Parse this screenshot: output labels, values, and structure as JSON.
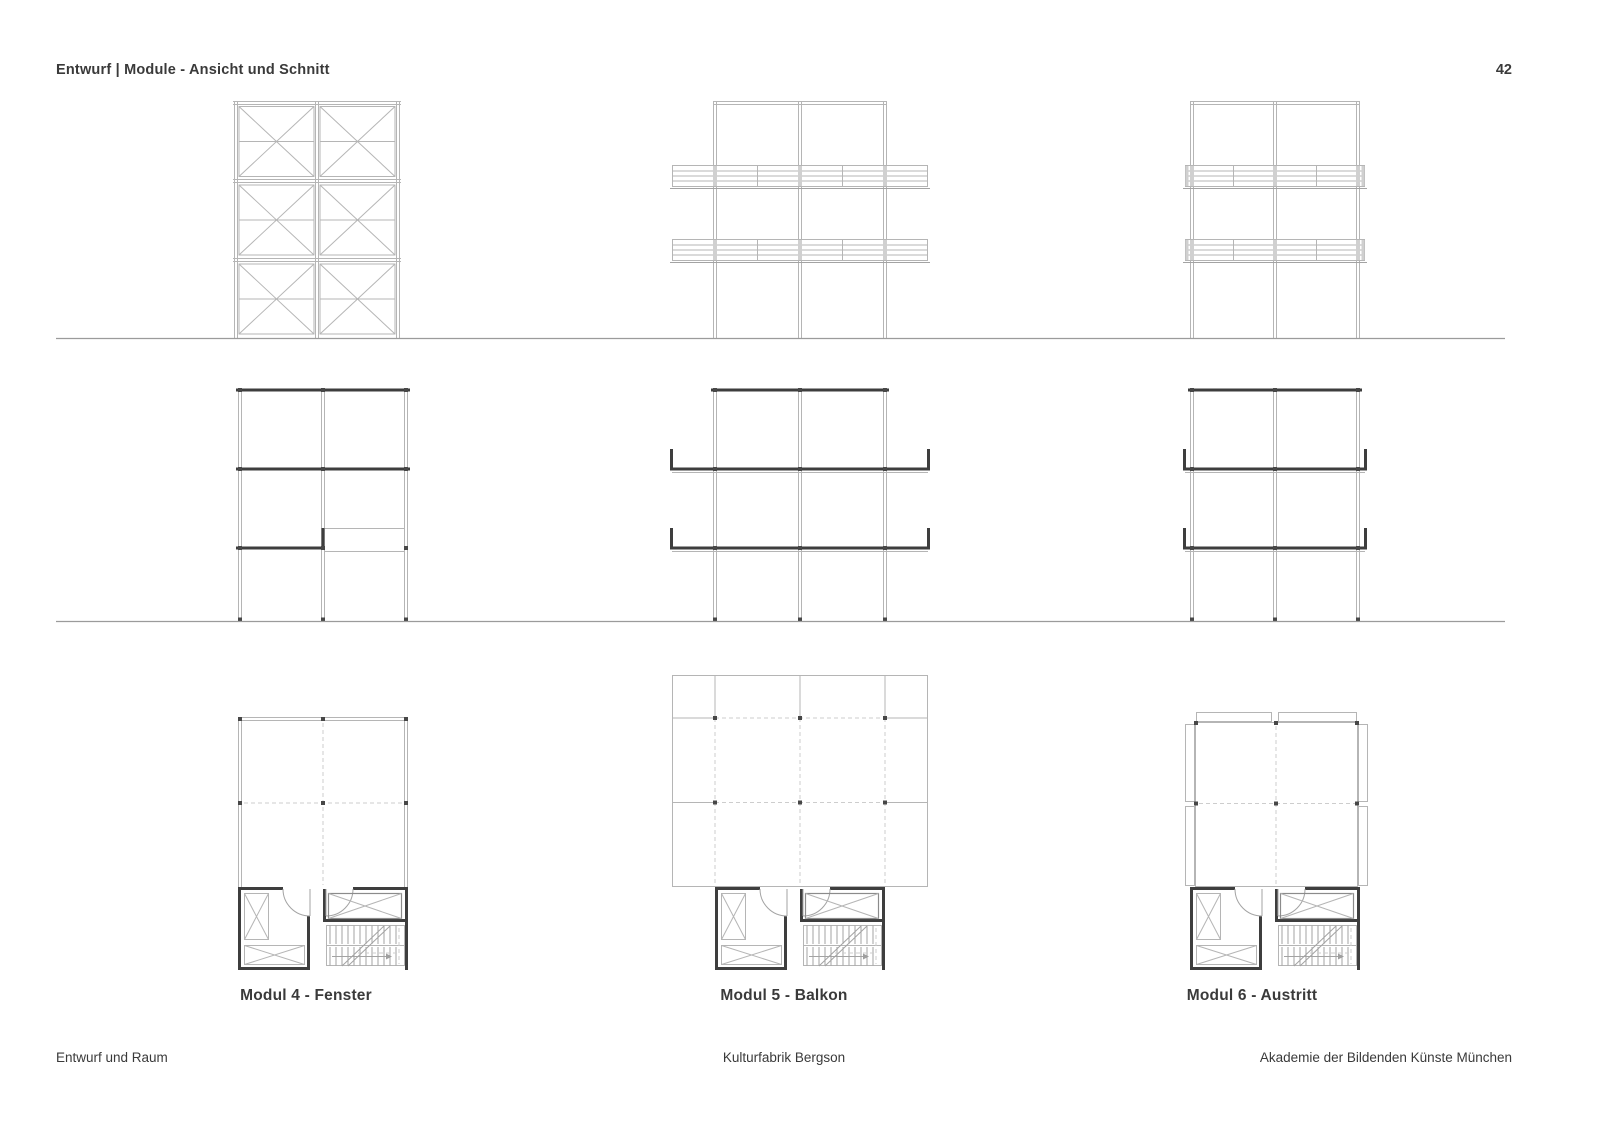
{
  "header": {
    "title": "Entwurf | Module - Ansicht und Schnitt",
    "page_number": "42"
  },
  "modules": [
    {
      "label": "Modul 4 - Fenster"
    },
    {
      "label": "Modul 5 - Balkon"
    },
    {
      "label": "Modul 6 - Austritt"
    }
  ],
  "figures": [
    "modul-4-elevation",
    "modul-5-elevation",
    "modul-6-elevation",
    "modul-4-section",
    "modul-5-section",
    "modul-6-section",
    "modul-4-floor-plan",
    "modul-5-floor-plan",
    "modul-6-floor-plan"
  ],
  "footer": {
    "left": "Entwurf und Raum",
    "center": "Kulturfabrik Bergson",
    "right": "Akademie der Bildenden Künste München"
  },
  "colors": {
    "background": "#ffffff",
    "line_light": "#b5b5b5",
    "line_dashed": "#cdcdcd",
    "line_dark": "#3e3e3e",
    "ground_line": "#9b9b9b",
    "text": "#3a3a3a"
  }
}
